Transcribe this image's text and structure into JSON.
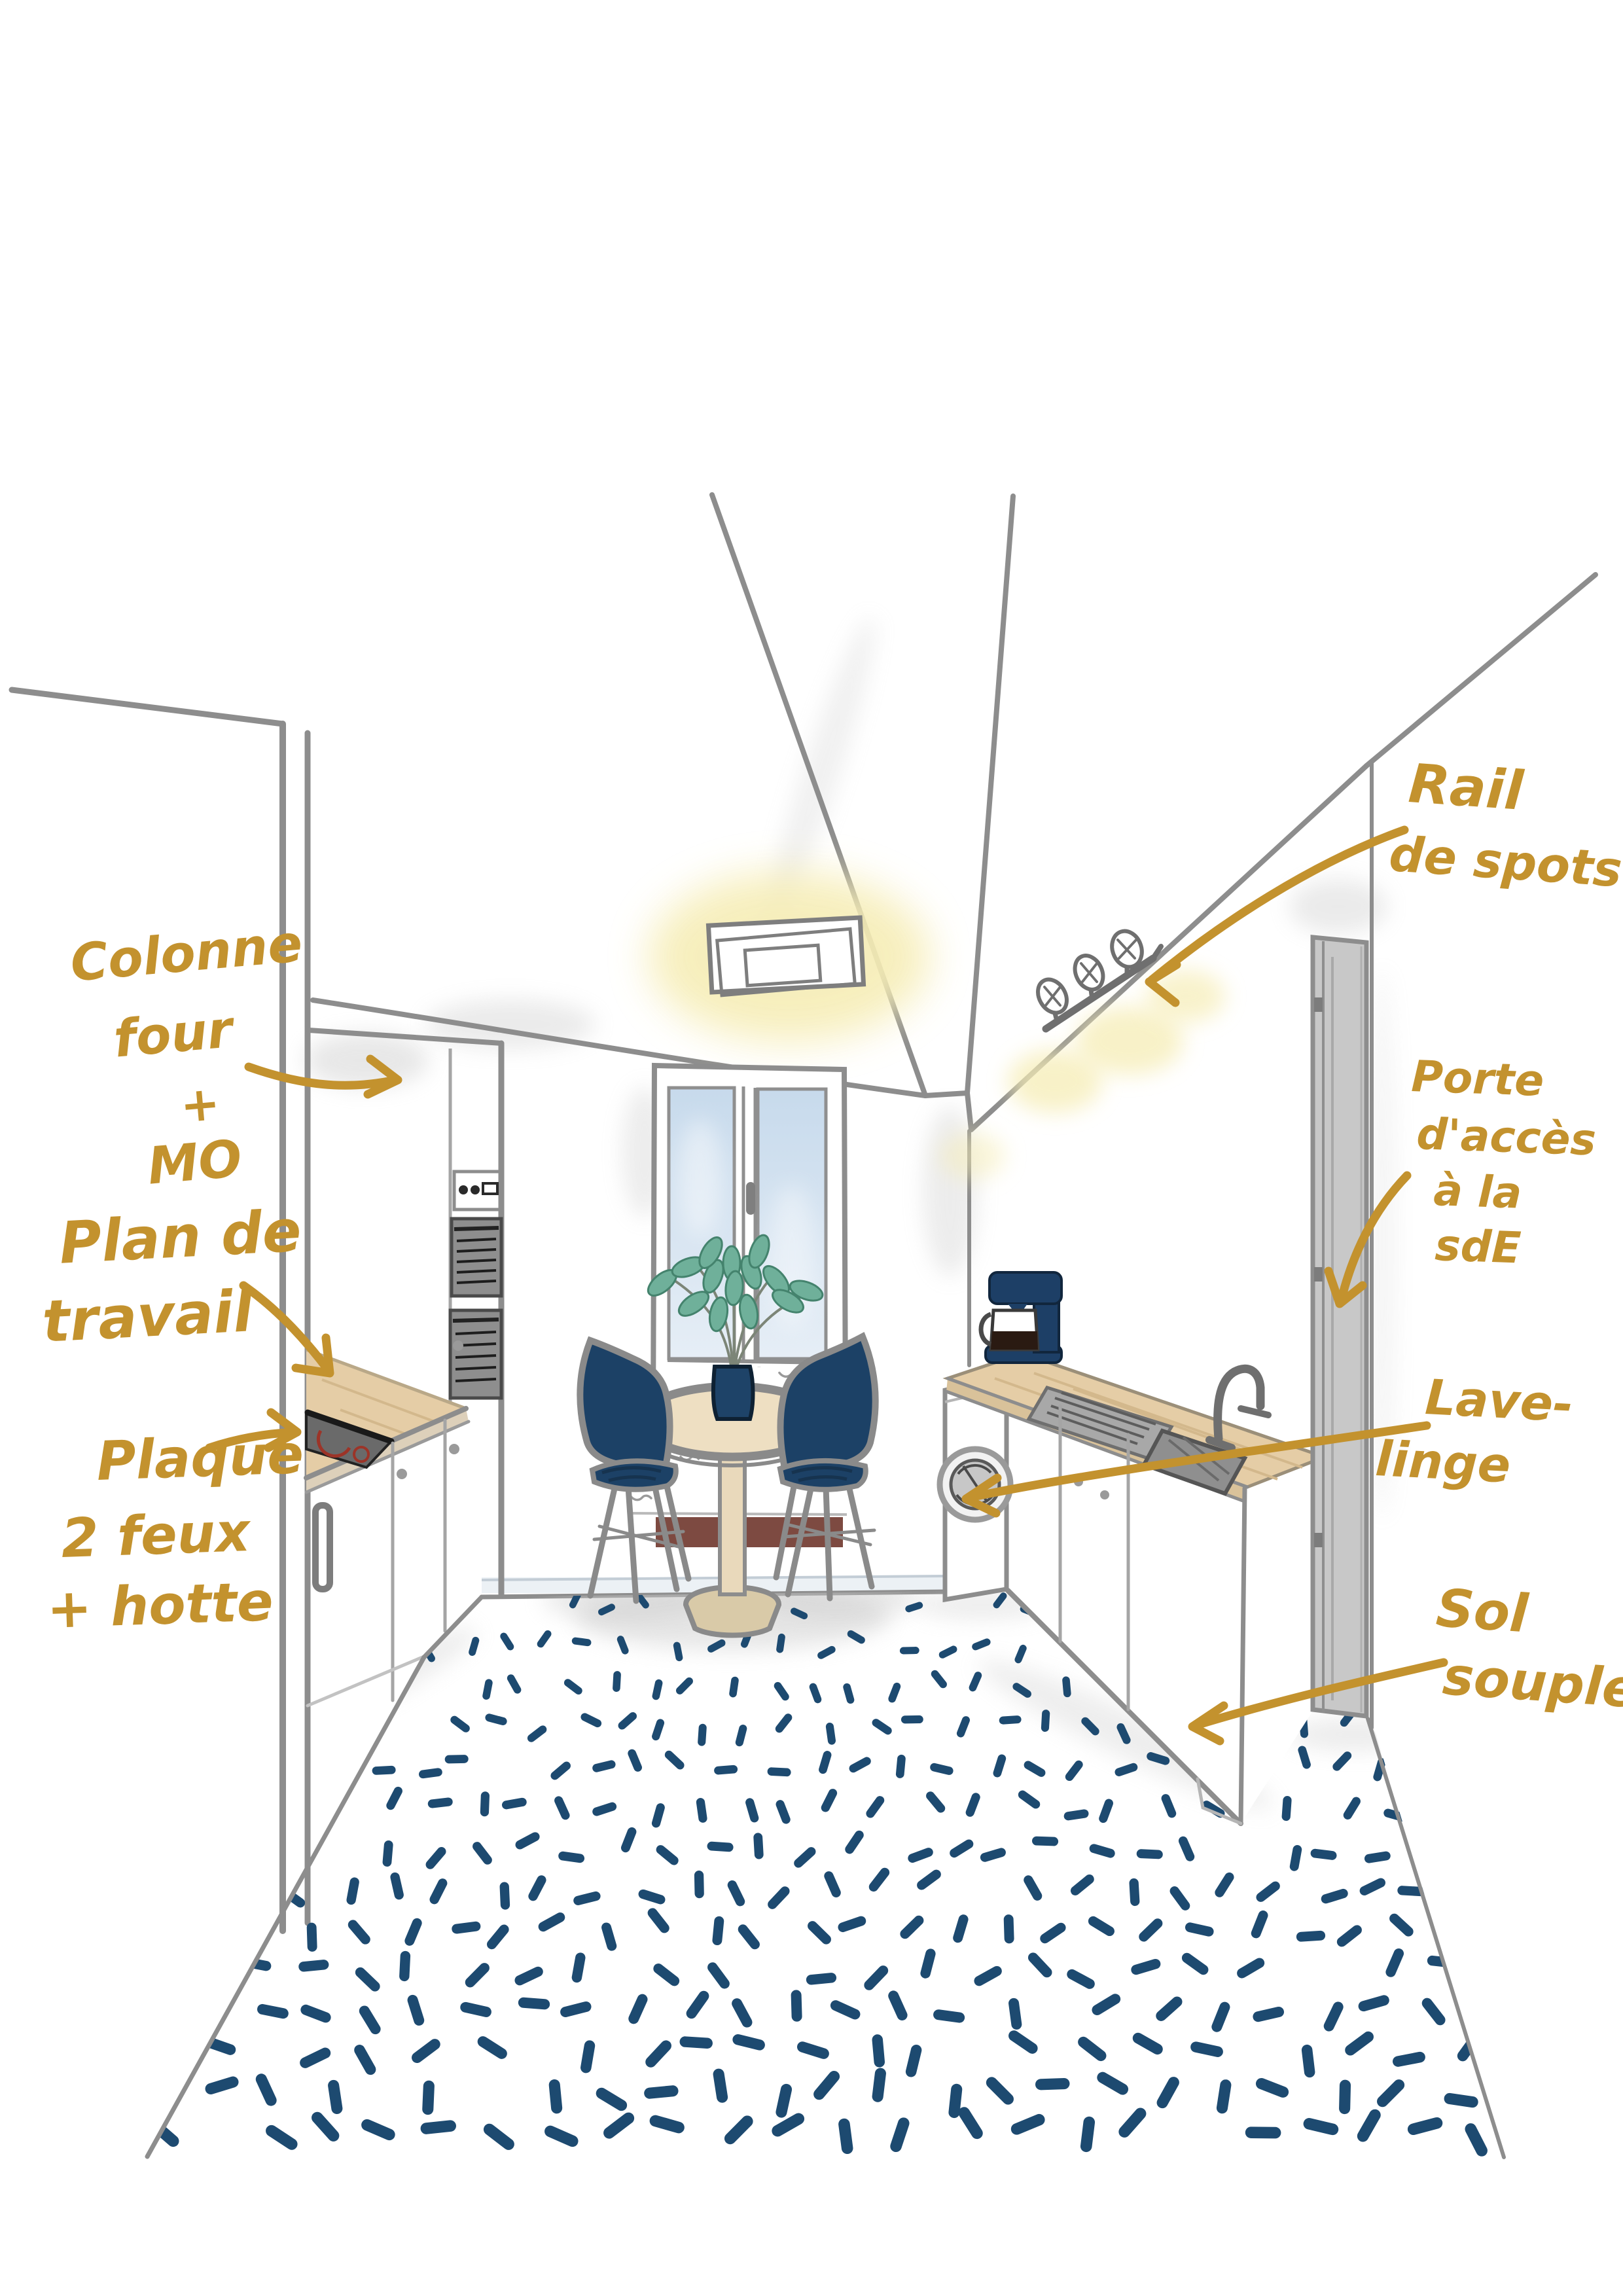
{
  "annotations": {
    "rail_de_spots": {
      "text": "Rail de spots",
      "lines": [
        "Rail",
        "de spots"
      ]
    },
    "colonne_four": {
      "text": "Colonne four + MO",
      "lines": [
        "Colonne",
        "four",
        "+",
        "MO"
      ]
    },
    "plan_de_travail": {
      "text": "Plan de travail",
      "lines": [
        "Plan de",
        "travail"
      ]
    },
    "plaque_feux": {
      "text": "Plaque 2 feux + hotte",
      "lines": [
        "Plaque",
        "2 feux",
        "+ hotte"
      ]
    },
    "porte_acces": {
      "text": "Porte d'accès à la sdE",
      "lines": [
        "Porte",
        "d'accès",
        "à la",
        "sdE"
      ]
    },
    "lave_linge": {
      "text": "Lave-linge",
      "lines": [
        "Lave-",
        "linge"
      ]
    },
    "sol_souple": {
      "text": "Sol souple",
      "lines": [
        "Sol",
        "souple"
      ]
    }
  },
  "palette": {
    "gold": "#c3922e",
    "line_gray": "#8d8d8d",
    "navy": "#1d4a70",
    "chair_navy": "#1c4166",
    "wood": "#e5cda6",
    "window_blue": "#cfdfee",
    "glow_yellow": "#f6edb6",
    "door_gray": "#c8c8c8",
    "radiator_maroon": "#7d4a41",
    "leaf_green": "#6fb09a",
    "appliance_gray": "#8e8e8e"
  }
}
